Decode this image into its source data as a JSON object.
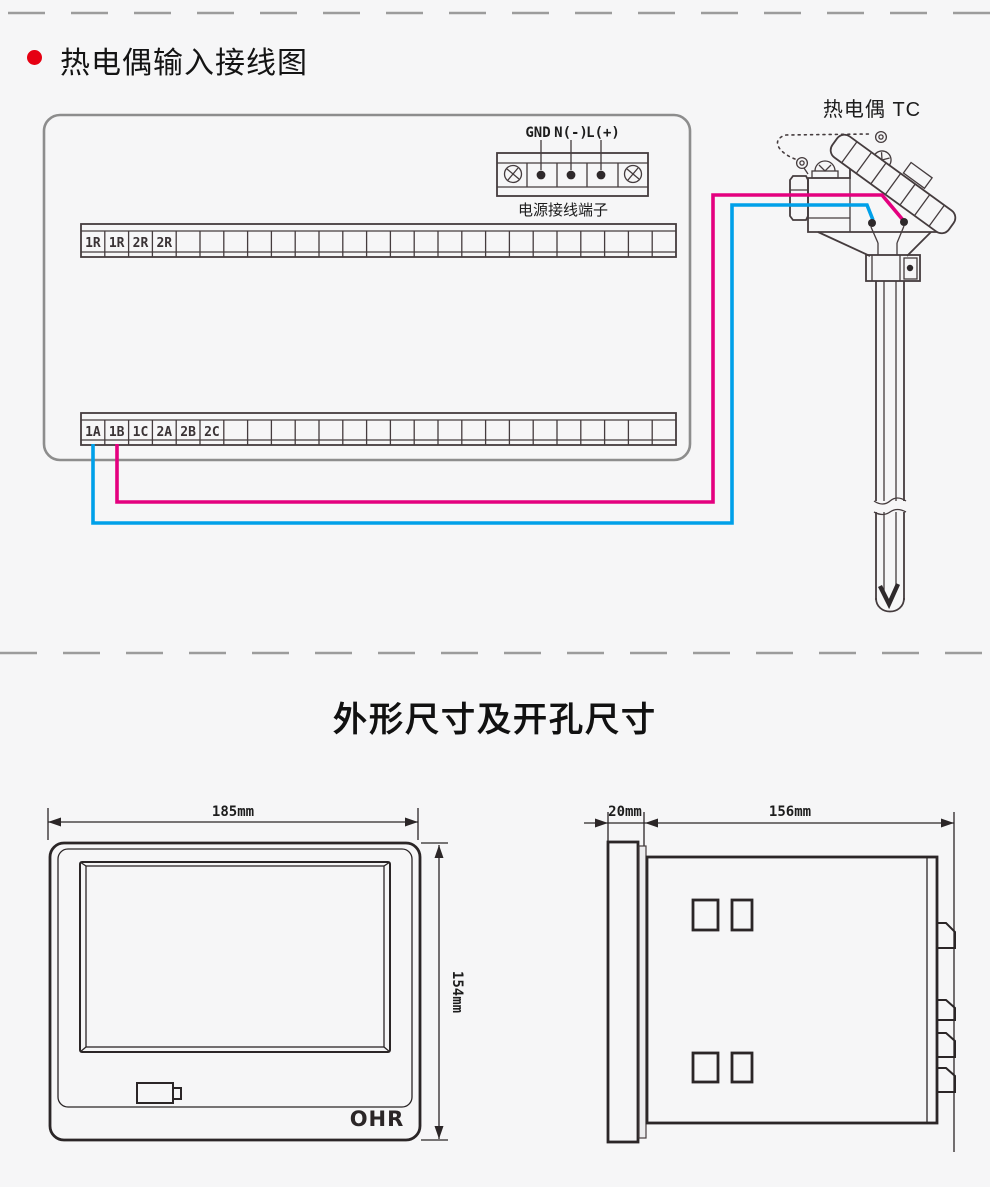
{
  "titles": {
    "section1": "热电偶输入接线图",
    "section2": "外形尺寸及开孔尺寸"
  },
  "wiring": {
    "power": {
      "labels": [
        "GND",
        "N(-)",
        "L(+)"
      ],
      "caption": "电源接线端子"
    },
    "strips": {
      "cells_per_strip": 25,
      "upper_labels": [
        "1R",
        "1R",
        "2R",
        "2R"
      ],
      "lower_labels": [
        "1A",
        "1B",
        "1C",
        "2A",
        "2B",
        "2C"
      ]
    },
    "thermocouple": {
      "label": "热电偶 TC"
    },
    "colors": {
      "bullet": "#e60012",
      "wire_positive": "#e4007f",
      "wire_negative": "#00a0e9"
    }
  },
  "dimensions": {
    "front": {
      "width": "185mm",
      "height": "154mm",
      "logo": "OHR"
    },
    "side": {
      "depth": "20mm",
      "body_depth": "156mm"
    }
  }
}
